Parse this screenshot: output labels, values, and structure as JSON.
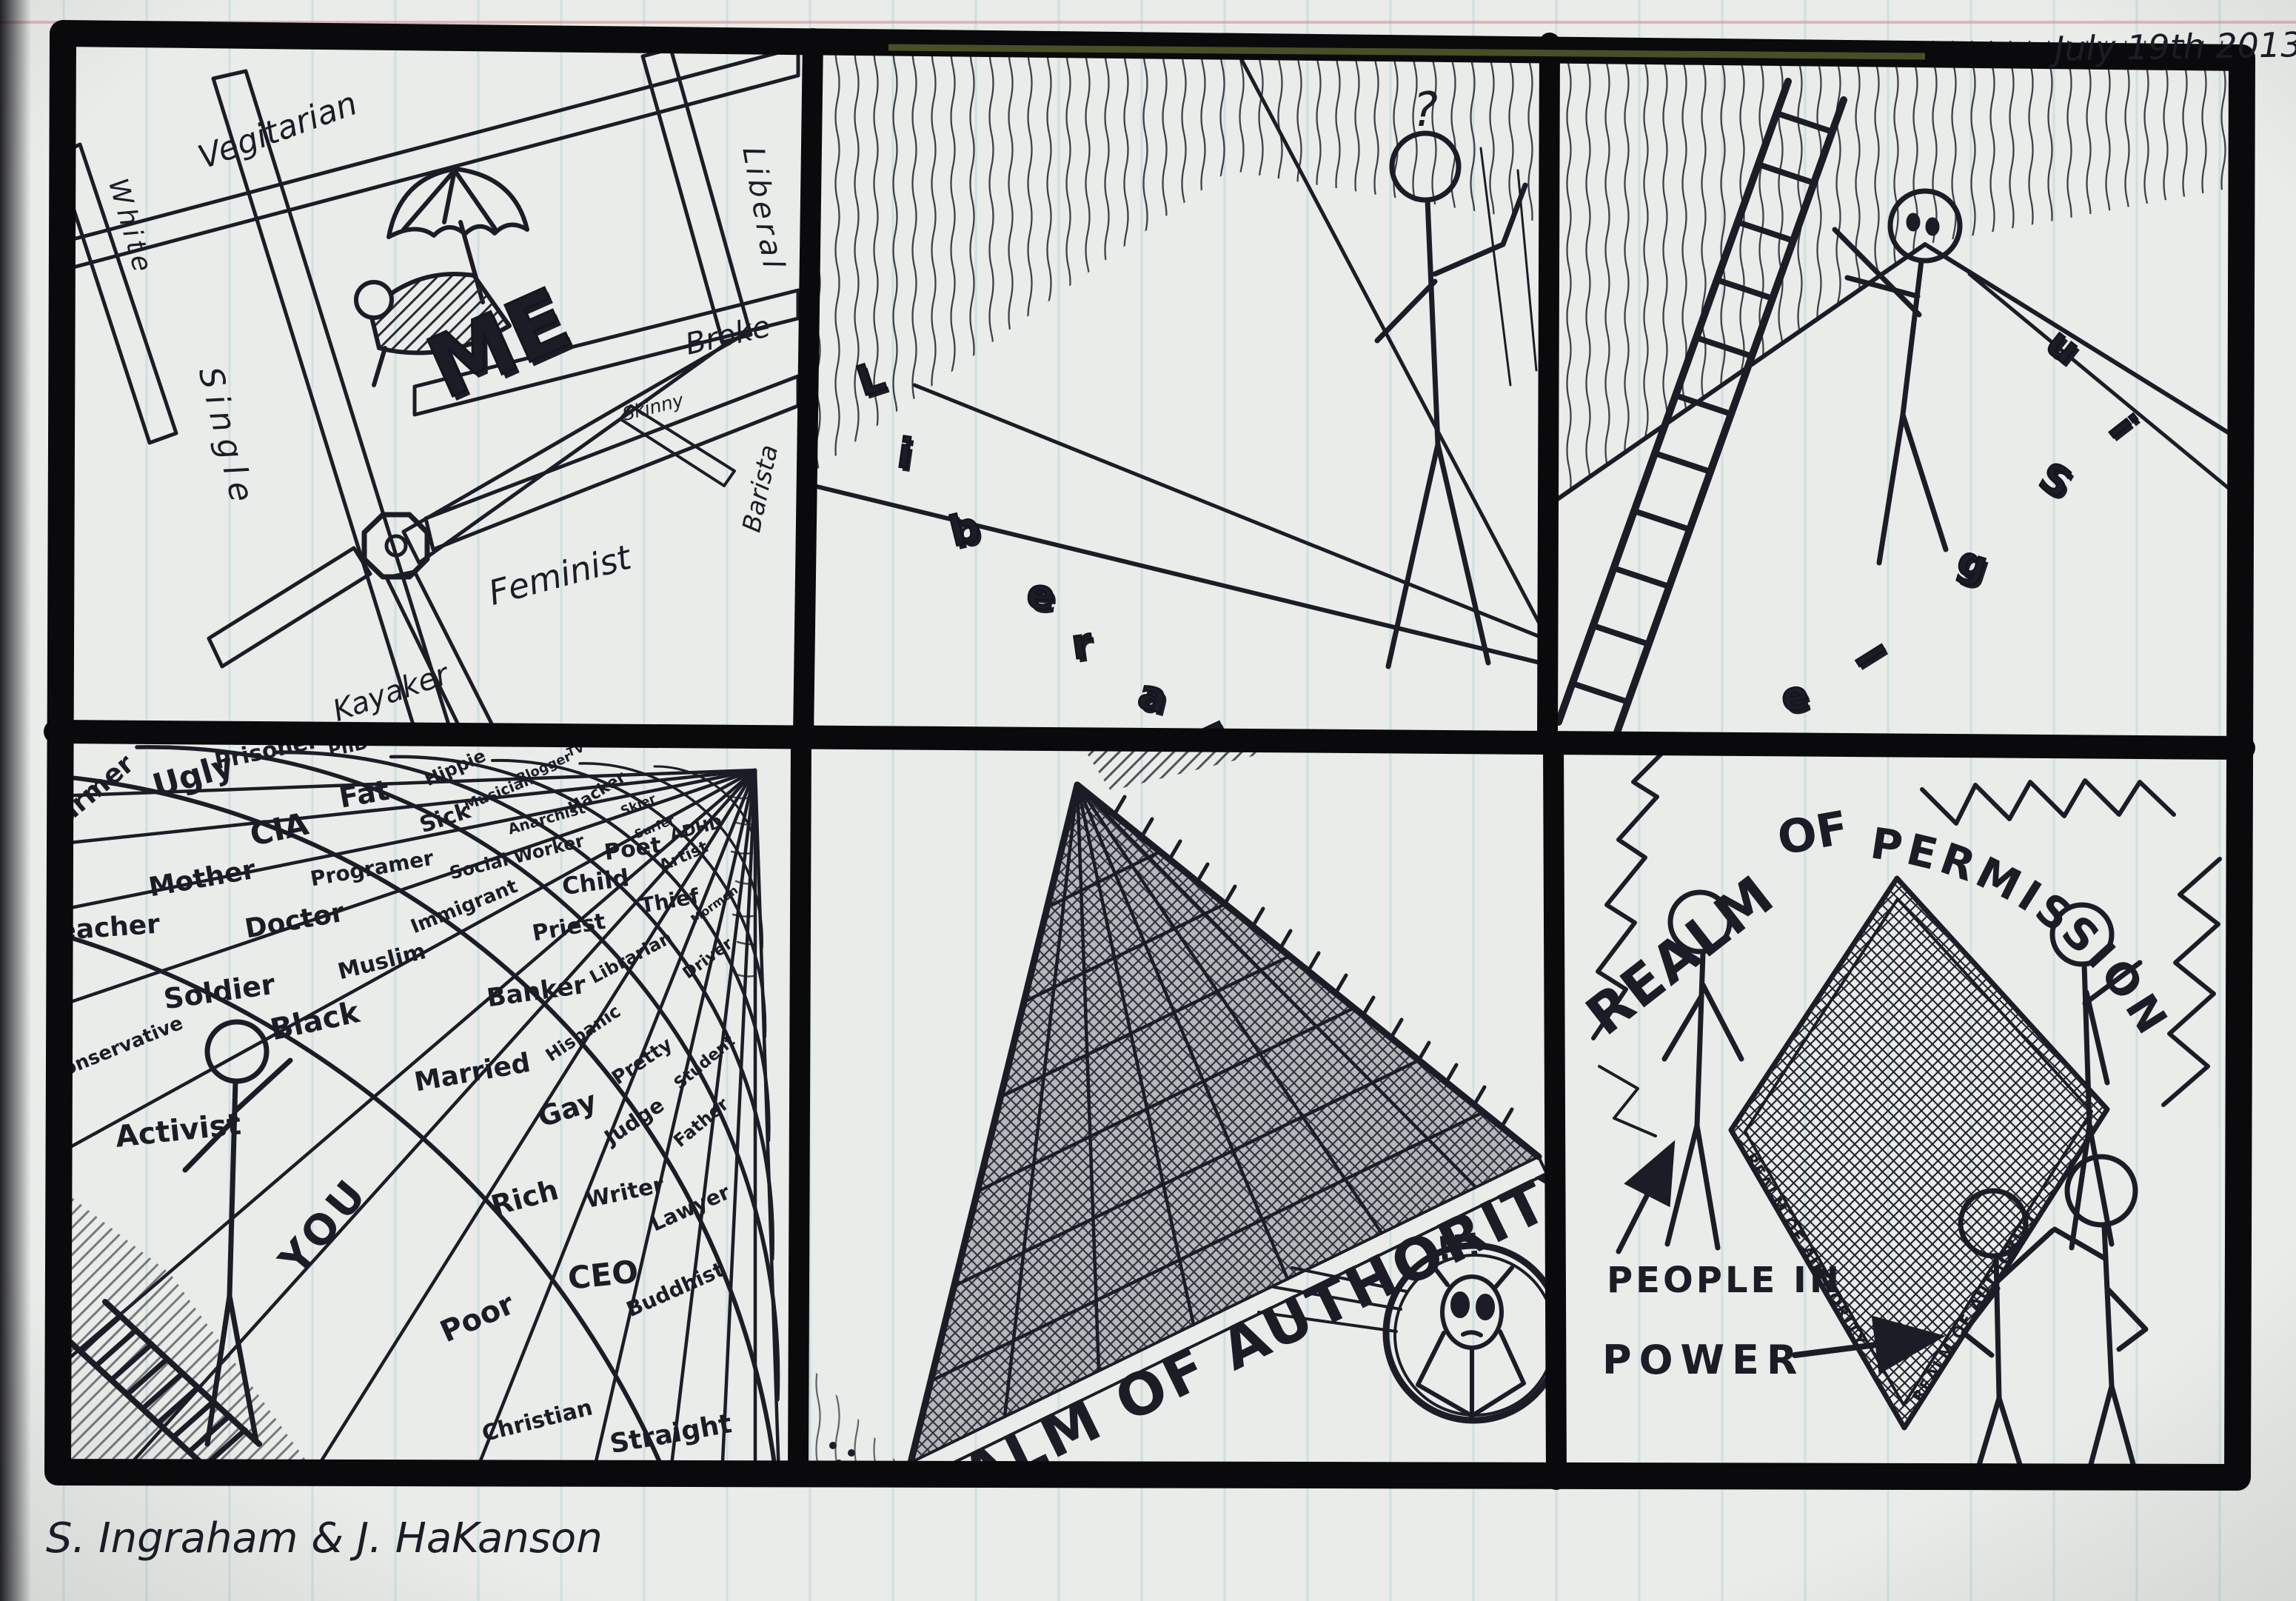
{
  "meta": {
    "date": "July 19th 2013",
    "signature": "S. Ingraham & J. HaKanson"
  },
  "panels": {
    "me_map": {
      "center": "ME",
      "streets": {
        "vegitarian": "Vegitarian",
        "white": "White",
        "single": "Single",
        "liberal": "Liberal",
        "broke": "Broke",
        "skinny": "Skinny",
        "barista": "Barista",
        "feminist": "Feminist",
        "kayaker": "Kayaker"
      }
    },
    "tightrope": {
      "question_mark": "?",
      "falling_letters": [
        "L",
        "i",
        "b",
        "e",
        "r",
        "a",
        "l"
      ]
    },
    "ladder_climb": {
      "falling_letters": [
        "u",
        "i",
        "S",
        "g",
        "l",
        "e"
      ]
    },
    "label_grid": {
      "labels": {
        "farmer": "Farmer",
        "ugly": "Ugly",
        "prisoner": "Prisoner",
        "phd": "PhD",
        "hippie": "Hippie",
        "fat": "Fat",
        "cia": "CIA",
        "sick": "Sick",
        "mother": "Mother",
        "programer": "Programer",
        "teacher": "Teacher",
        "doctor": "Doctor",
        "immigrant": "Immigrant",
        "soldier": "Soldier",
        "muslim": "Muslim",
        "musician": "Musician",
        "blogger": "Blogger",
        "tv": "TV",
        "hacker": "Hacker",
        "anarchist": "Anarchist",
        "social_worker": "Social Worker",
        "poet": "Poet",
        "child": "Child",
        "thief": "Thief",
        "priest": "Priest",
        "librarian": "Librarian",
        "banker": "Banker",
        "skier": "Skier",
        "surfer": "Surfer",
        "adhd": "ADHD",
        "artist": "Artist",
        "driver": "Driver",
        "mormon": "Mormon",
        "conservative": "Conservative",
        "black": "Black",
        "activist": "Activist",
        "you": "YOU",
        "married": "Married",
        "hispanic": "Hispanic",
        "pretty": "Pretty",
        "student": "Student",
        "gay": "Gay",
        "judge": "Judge",
        "father": "Father",
        "rich": "Rich",
        "writer": "Writer",
        "lawyer": "Lawyer",
        "ceo": "CEO",
        "buddhist": "Buddhist",
        "poor": "Poor",
        "christian": "Christian",
        "straight": "Straight"
      }
    },
    "authority": {
      "caption": "REALM OF AUTHORITY",
      "exclamation": "!!!"
    },
    "permission": {
      "realm": "REALM",
      "of": "OF",
      "permission": "PERMISSION",
      "net_edge_label": "REALM OF AUTHORITY",
      "people_in": "PEOPLE IN",
      "power": "POWER"
    }
  }
}
